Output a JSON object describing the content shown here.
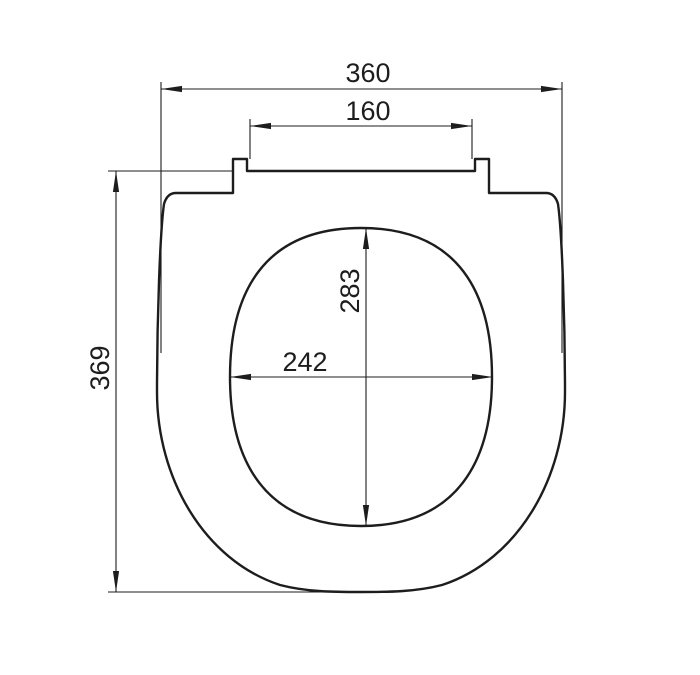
{
  "colors": {
    "line": "#1d1d1d",
    "text": "#1d1d1d",
    "background": "#ffffff"
  },
  "drawing": {
    "subject": "toilet-seat-top-view",
    "dimensions": {
      "overall_width": "360",
      "hinge_spacing": "160",
      "overall_depth": "369",
      "opening_depth": "283",
      "opening_width": "242"
    }
  }
}
